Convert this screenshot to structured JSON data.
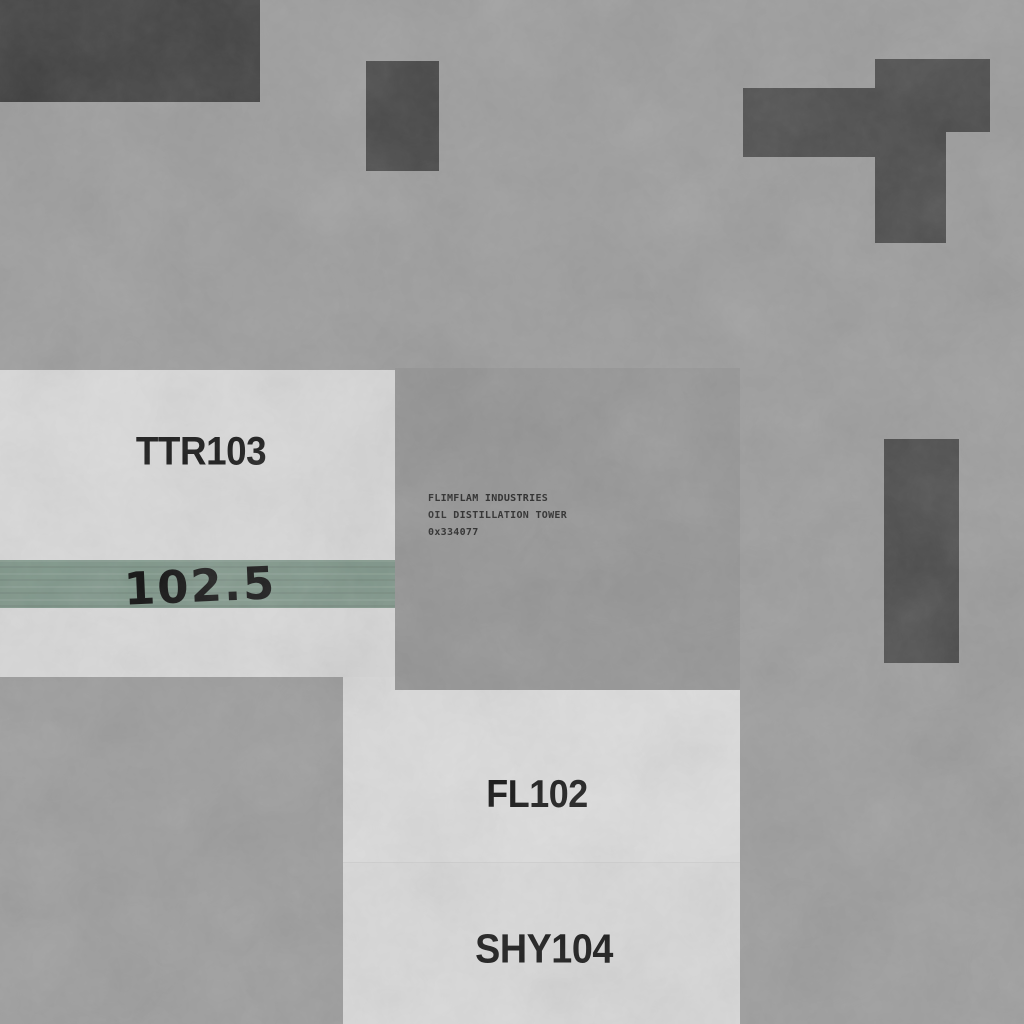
{
  "colors": {
    "background": "#9b9b9b",
    "panel_light": "#d9d9d9",
    "panel_light_upper": "#dcdcdc",
    "panel_center": "#939393",
    "dark_block": "#3b3b3b",
    "dark_shape": "#474747",
    "stripe_green": "#7c9487",
    "label_text": "#0f0f0f",
    "plate_text": "#222222"
  },
  "labels": {
    "ttr": "TTR103",
    "stripe_value": "102.5",
    "fl": "FL102",
    "shy": "SHY104"
  },
  "plate": {
    "line1": "FLIMFLAM INDUSTRIES",
    "line2": "OIL DISTILLATION TOWER",
    "line3": "0x334077"
  }
}
